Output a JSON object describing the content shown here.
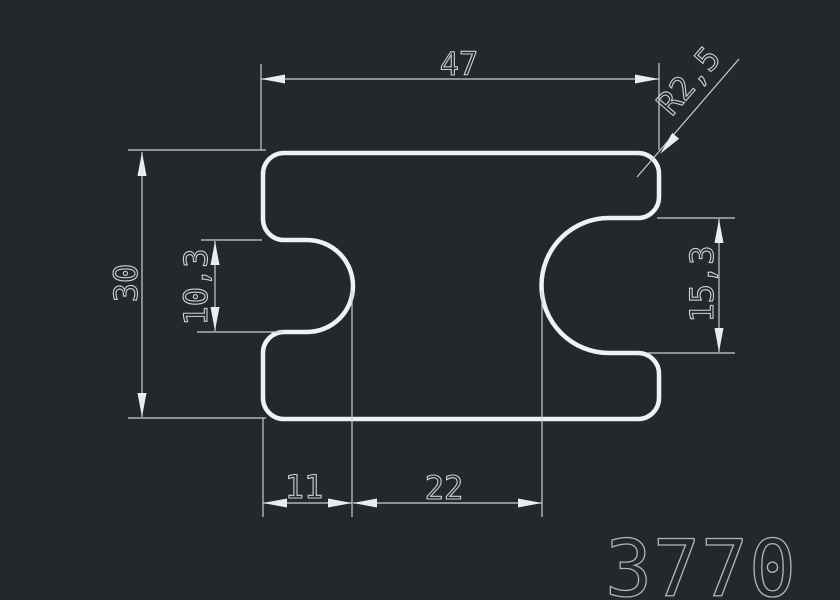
{
  "drawing": {
    "part_number": "3770",
    "dims": {
      "overall_width": "47",
      "overall_height": "30",
      "corner_radius": "R2,5",
      "left_notch_height": "10,3",
      "right_notch_height": "15,3",
      "left_notch_depth": "11",
      "inner_span": "22"
    },
    "colors": {
      "background": "#24282b",
      "profile_outline": "#eef2f4",
      "dimension_lines": "#c9cdd0",
      "dimension_text": "#cdd1d5",
      "part_number_text": "#b2b6ba"
    }
  }
}
